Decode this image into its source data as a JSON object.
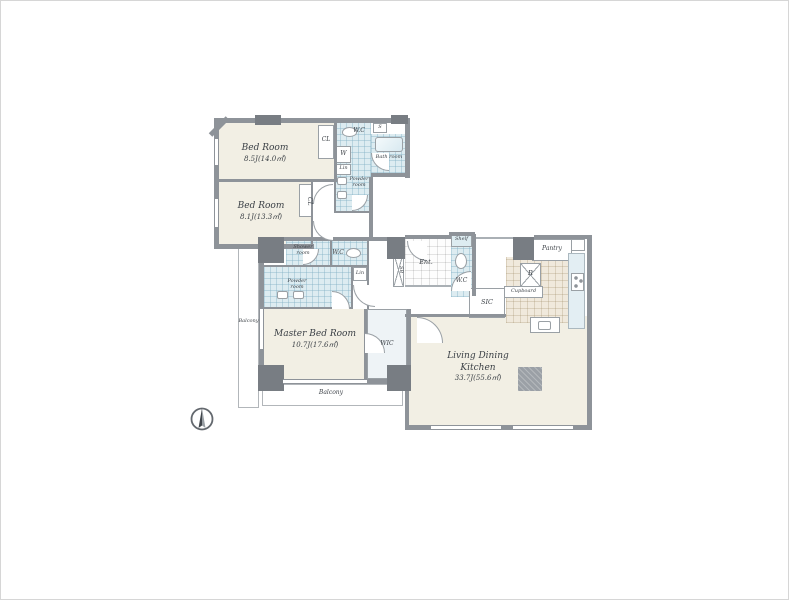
{
  "plan": {
    "rooms": {
      "bedroom1": {
        "name": "Bed Room",
        "size": "8.5J(14.0㎡)"
      },
      "bedroom2": {
        "name": "Bed Room",
        "size": "8.1J(13.3㎡)"
      },
      "master_bedroom": {
        "name": "Master Bed Room",
        "size": "10.7J(17.6㎡)"
      },
      "ldk": {
        "name": "Living Dining Kitchen",
        "size": "33.7J(55.6㎡)"
      }
    },
    "labels": {
      "cl1": "CL",
      "cl2": "CL",
      "wc_top": "W.C",
      "wc_mid": "W.C",
      "wc_entry": "W.C",
      "washer": "W",
      "s_closet": "S",
      "lin_top": "Lin",
      "lin_mid": "Lin",
      "bath": "Bath room",
      "powder_top": "Powder room",
      "powder_mid": "Powder room",
      "shower": "Shower room",
      "wic": "WIC",
      "sic": "SIC",
      "sb": "SB",
      "entry": "Ent.",
      "shelf": "Shelf",
      "pantry": "Pantry",
      "fridge": "R",
      "cupboard": "Cupboard",
      "balcony_left": "Balcony",
      "balcony_bottom": "Balcony"
    },
    "colors": {
      "wall": "#8e9399",
      "pillar": "#787d83",
      "floor": "#f2efe4",
      "wet_area": "#ddecf1",
      "counter": "#e3eef3",
      "kitchen_tile": "#f0e9dc"
    }
  }
}
